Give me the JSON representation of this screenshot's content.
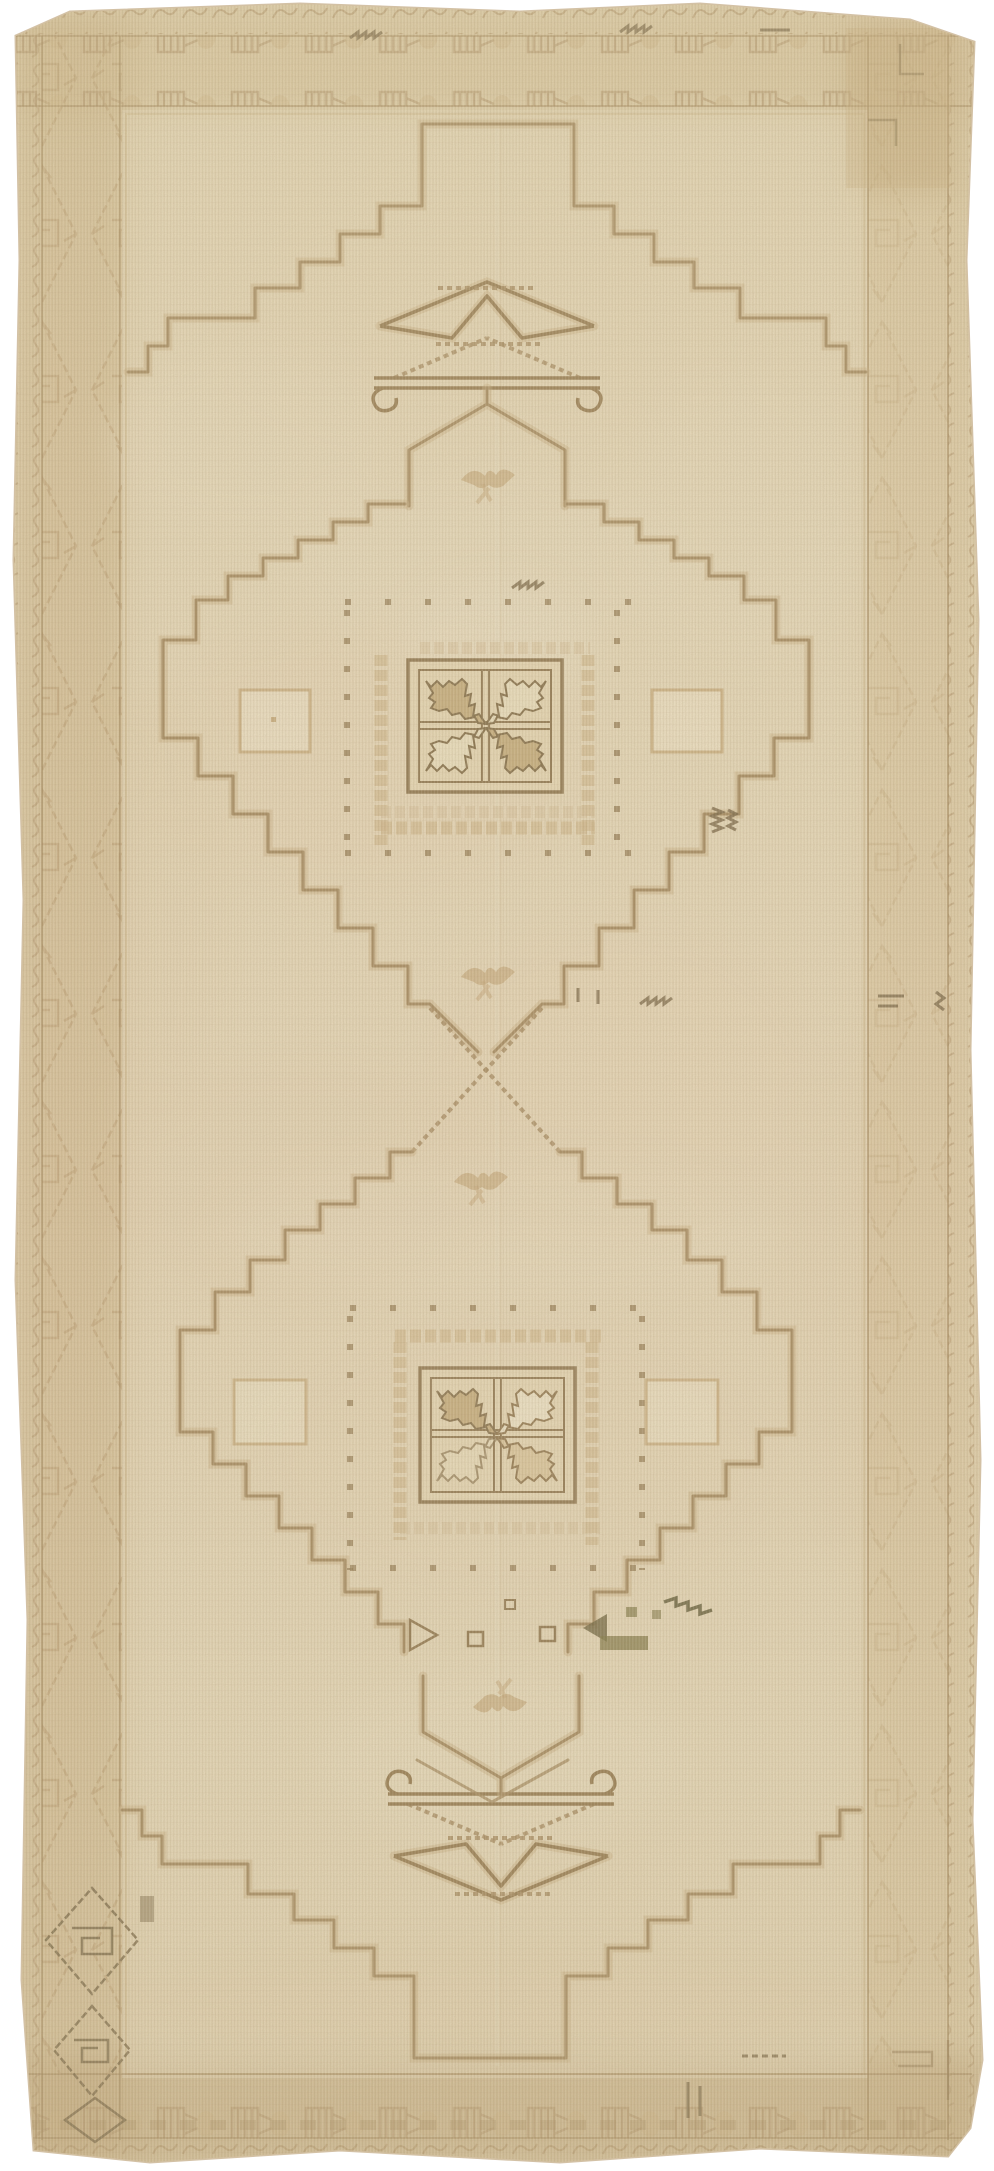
{
  "image": {
    "title": "Vintage faded Anatolian Oushak rug with two stepped medallions",
    "alt": "Faded cream and tan antique Turkish rug: two stepped diamond medallions with serrated pinwheel star panels, latch-hook tree motifs at both ends, hexagonal bird pendants, geometric hooked borders and a dark hooked-diamond motif in the lower left border",
    "note": "photograph of a textile; no UI elements or text visible"
  },
  "palette": {
    "base": "#e7d9b8",
    "field": "#ebdfc1",
    "border_band": "#dcc8a0",
    "outline": "#a1855a",
    "outline_dark": "#8a7048",
    "motif_tan": "#bb9e70",
    "checker_tan": "#cfb487",
    "leaf_fill": "#c3a877",
    "leaf_light": "#f0e5c6",
    "dark_accent": "#6b5939",
    "olive_accent": "#716b38",
    "blush_wash": "#e5c6a6",
    "wear_light": "#f3ead2"
  },
  "motifs": {
    "field": [
      "stepped gable",
      "latch-hook zigzag tree",
      "hexagonal pendant with bird",
      "stepped diamond medallion",
      "serrated pinwheel star panel",
      "checker ring",
      "square dot ring",
      "flanking blank squares",
      "crossed serrated diagonals"
    ],
    "border": [
      "hooked castle motifs",
      "serrated leaf diamonds",
      "scroll guard stripe",
      "dark hooked diamond bottom-left",
      "olive triangle row"
    ]
  }
}
